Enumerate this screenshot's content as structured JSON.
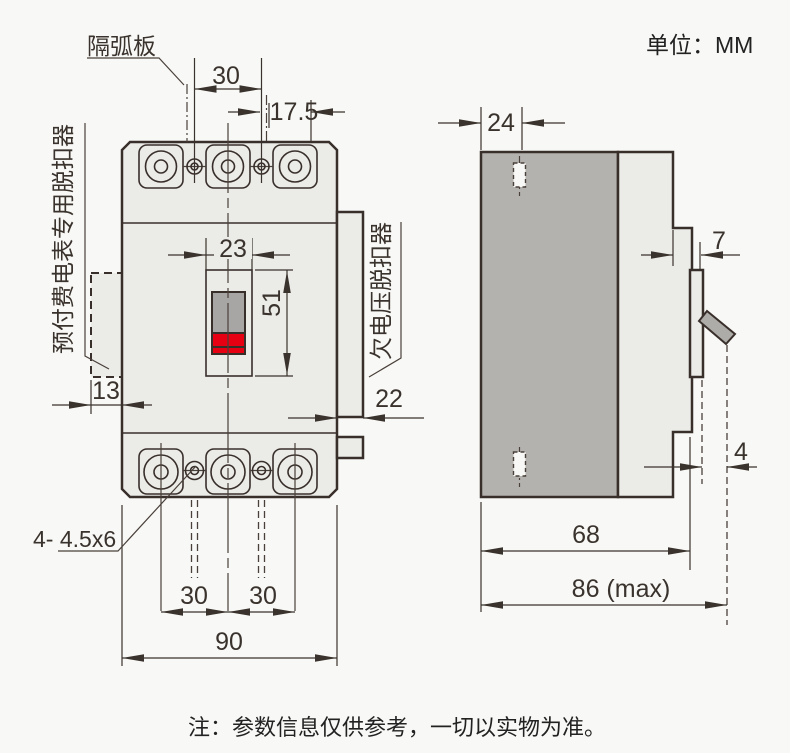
{
  "unit_label": "单位：MM",
  "note": "注：参数信息仅供参考，一切以实物为准。",
  "labels": {
    "arc_plate": "隔弧板",
    "prepaid_meter_release": "预付费电表专用脱扣器",
    "undervoltage_release": "欠电压脱扣器",
    "mounting_holes": "4- 4.5x6"
  },
  "front_view": {
    "dims": {
      "terminal_pitch_top": "30",
      "offset_top_right": "17.5",
      "handle_window_width": "23",
      "handle_window_height": "51",
      "left_module_width": "13",
      "right_module_width": "22",
      "mount_pitch_left": "30",
      "mount_pitch_right": "30",
      "overall_width": "90"
    }
  },
  "side_view": {
    "dims": {
      "mount_hole_depth": "24",
      "panel_step": "7",
      "handle_projection": "4",
      "body_depth": "68",
      "max_depth": "86 (max)"
    }
  },
  "colors": {
    "background": "#f8f8f6",
    "body_fill": "#ebebe8",
    "dark_gray_fill": "#b4b2af",
    "handle_gray": "#a8a6a4",
    "handle_red": "#e60012",
    "line": "#392f2a"
  }
}
